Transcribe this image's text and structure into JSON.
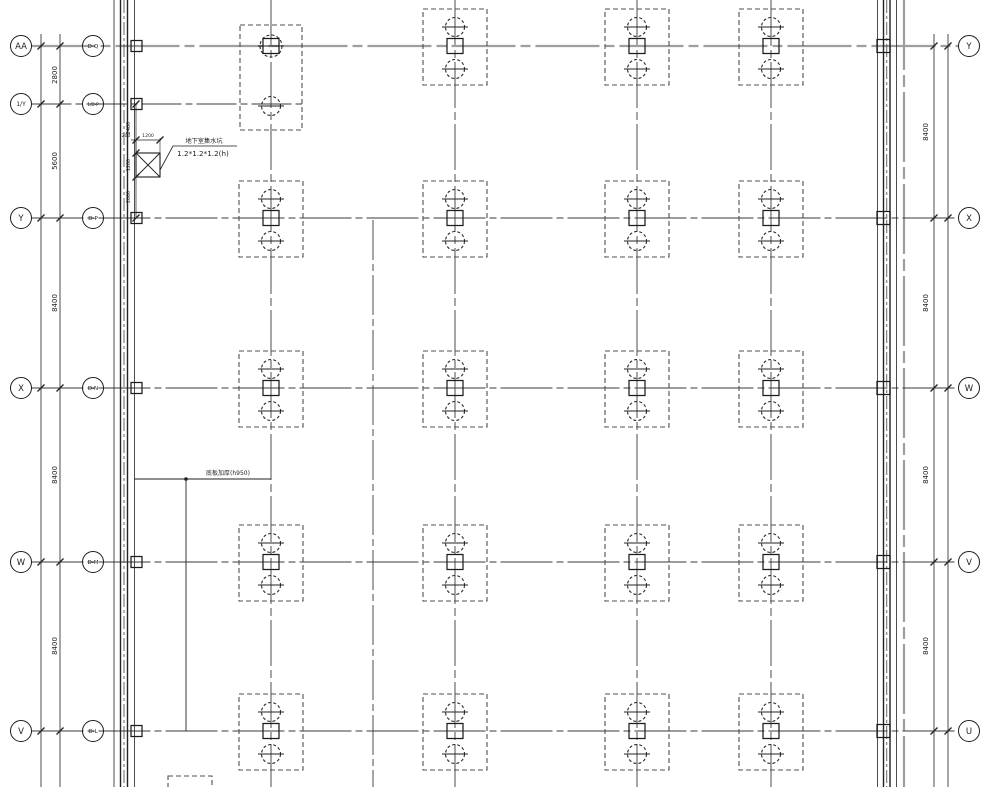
{
  "title": "pile cap foundation plan",
  "colors": {
    "bg": "#ffffff",
    "line": "#222222",
    "row_line": "#3a3a3a",
    "gray_line": "#9e9e9e",
    "cap_dash": "#4f4f4f"
  },
  "grid": {
    "rows": [
      {
        "y": 46,
        "left": "AA",
        "inner": "D-Q",
        "right": "Y",
        "gray": true
      },
      {
        "y": 104,
        "left": "1/Y",
        "inner": "1/D-P",
        "right": ""
      },
      {
        "y": 218,
        "left": "Y",
        "inner": "D-P",
        "right": "X"
      },
      {
        "y": 388,
        "left": "X",
        "inner": "D-N",
        "right": "W"
      },
      {
        "y": 562,
        "left": "W",
        "inner": "D-M",
        "right": "V"
      },
      {
        "y": 731,
        "left": "V",
        "inner": "D-L",
        "right": "U"
      }
    ],
    "left_dims": [
      {
        "t": "2800",
        "y": 75
      },
      {
        "t": "5600",
        "y": 161
      },
      {
        "t": "8400",
        "y": 303
      },
      {
        "t": "8400",
        "y": 475
      },
      {
        "t": "8400",
        "y": 646
      }
    ],
    "right_dims": [
      {
        "t": "8400",
        "y": 132
      },
      {
        "t": "8400",
        "y": 303
      },
      {
        "t": "8400",
        "y": 475
      },
      {
        "t": "8400",
        "y": 646
      }
    ],
    "cap_cols_x": [
      271,
      455,
      637,
      771
    ],
    "cap_rows_y": [
      218,
      388,
      562,
      731
    ],
    "top_row_y": 46,
    "top_cap_cols_x": [
      455,
      637,
      771
    ]
  },
  "sump": {
    "label_line1": "地下室集水坑",
    "label_line2": "1.2*1.2*1.2(h)",
    "dim_offset": "200",
    "dim_width": "1200",
    "vchain": [
      {
        "t": "2400",
        "y": 128
      },
      {
        "t": "1200",
        "y": 165
      },
      {
        "t": "2000",
        "y": 197
      }
    ]
  },
  "slab_note": {
    "text": "底板加厚(h950)"
  }
}
